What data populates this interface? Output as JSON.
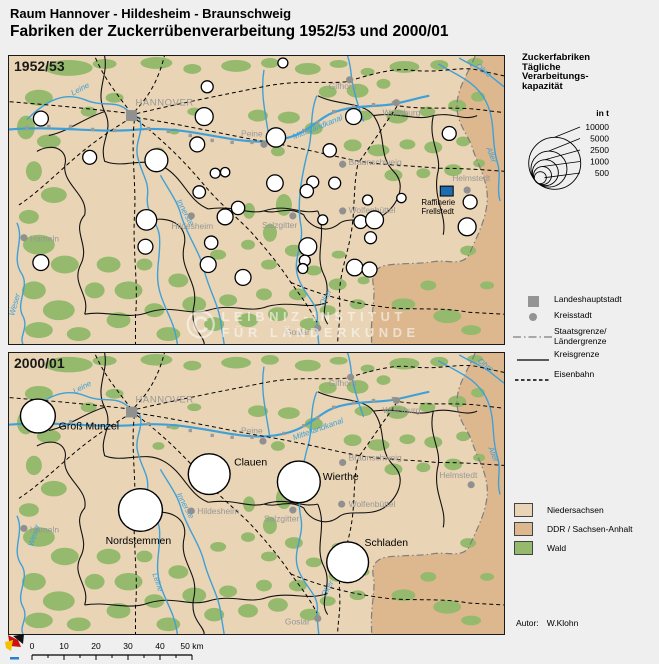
{
  "header": {
    "region_line": "Raum Hannover - Hildesheim - Braunschweig",
    "title_line": "Fabriken der Zuckerrübenverarbeitung 1952/53 und 2000/01"
  },
  "watermark": {
    "symbol": "©",
    "line1": "LEIBNIZ-INSTITUT",
    "line2": "FÜR LÄNDERKUNDE"
  },
  "colors": {
    "niedersachsen": "#e9d4b5",
    "ddr": "#ddb88f",
    "wald": "#95b96d",
    "river": "#3fa0d8",
    "city_gray": "#979797",
    "factory_fill": "#ffffff",
    "factory_stroke": "#000000",
    "refinery_blue": "#1b6db0"
  },
  "map_1952": {
    "year_label": "1952/53",
    "cities": [
      {
        "name": "HANNOVER",
        "type": "capital",
        "dot": [
          123,
          60
        ],
        "label": [
          127,
          50
        ],
        "anchor": "start",
        "caps": true
      },
      {
        "name": "Gifhorn",
        "type": "kreis",
        "dot": [
          342,
          24
        ],
        "label": [
          321,
          33
        ],
        "anchor": "start"
      },
      {
        "name": "Wolfsburg",
        "type": "kreis",
        "dot": [
          389,
          47
        ],
        "label": [
          375,
          60
        ],
        "anchor": "start"
      },
      {
        "name": "Braunschweig",
        "type": "kreis",
        "dot": [
          335,
          109
        ],
        "label": [
          341,
          110
        ],
        "anchor": "start"
      },
      {
        "name": "Peine",
        "type": "kreis",
        "dot": [
          256,
          89
        ],
        "label": [
          233,
          81
        ],
        "anchor": "start"
      },
      {
        "name": "Salzgitter",
        "type": "kreis",
        "dot": [
          285,
          161
        ],
        "label": [
          254,
          173
        ],
        "anchor": "start"
      },
      {
        "name": "Hildesheim",
        "type": "kreis",
        "dot": [
          183,
          161
        ],
        "label": [
          163,
          174
        ],
        "anchor": "start"
      },
      {
        "name": "Hameln",
        "type": "kreis",
        "dot": [
          15,
          183
        ],
        "label": [
          21,
          187
        ],
        "anchor": "start"
      },
      {
        "name": "Wolfenbüttel",
        "type": "kreis",
        "dot": [
          335,
          156
        ],
        "label": [
          341,
          158
        ],
        "anchor": "start"
      },
      {
        "name": "Helmstedt",
        "type": "kreis",
        "dot": [
          460,
          135
        ],
        "label": [
          445,
          126
        ],
        "anchor": "start"
      },
      {
        "name": "Goslar",
        "type": "kreis",
        "dot": [
          310,
          274
        ],
        "label": [
          277,
          281
        ],
        "anchor": "start"
      }
    ],
    "river_labels": [
      {
        "name": "Leine",
        "x": 64,
        "y": 40,
        "rot": -28
      },
      {
        "name": "Mittellandkanal",
        "x": 286,
        "y": 84,
        "rot": -22
      },
      {
        "name": "Innerste",
        "x": 168,
        "y": 146,
        "rot": 62
      },
      {
        "name": "Ohre",
        "x": 468,
        "y": 11,
        "rot": 38
      },
      {
        "name": "Aller",
        "x": 479,
        "y": 93,
        "rot": 68
      },
      {
        "name": "Oker",
        "x": 316,
        "y": 252,
        "rot": -62
      },
      {
        "name": "Weser",
        "x": 5,
        "y": 262,
        "rot": -74
      }
    ],
    "factories": [
      [
        199,
        31,
        6
      ],
      [
        275,
        7,
        5
      ],
      [
        196,
        61,
        9
      ],
      [
        32,
        63,
        7.5
      ],
      [
        81,
        102,
        7
      ],
      [
        148,
        105,
        11.5
      ],
      [
        189,
        89,
        7.5
      ],
      [
        207,
        118,
        5
      ],
      [
        217,
        117,
        4.7
      ],
      [
        191,
        137,
        6.3
      ],
      [
        346,
        61,
        8
      ],
      [
        268,
        82,
        9.7
      ],
      [
        322,
        95,
        6.7
      ],
      [
        442,
        78,
        7
      ],
      [
        267,
        128,
        8.3
      ],
      [
        305,
        127,
        6
      ],
      [
        299,
        136,
        6.7
      ],
      [
        327,
        128,
        6
      ],
      [
        360,
        145,
        5
      ],
      [
        394,
        143,
        4.7
      ],
      [
        463,
        147,
        7
      ],
      [
        138,
        165,
        10.3
      ],
      [
        137,
        192,
        7.5
      ],
      [
        32,
        208,
        8
      ],
      [
        217,
        162,
        8
      ],
      [
        230,
        153,
        6.7
      ],
      [
        203,
        188,
        6.7
      ],
      [
        200,
        210,
        8
      ],
      [
        235,
        223,
        8
      ],
      [
        315,
        165,
        5
      ],
      [
        353,
        167,
        6.7
      ],
      [
        367,
        165,
        9
      ],
      [
        363,
        183,
        6
      ],
      [
        300,
        192,
        9
      ],
      [
        297,
        206,
        5.5
      ],
      [
        295,
        214,
        5
      ],
      [
        347,
        213,
        8.3
      ],
      [
        362,
        215,
        7.5
      ],
      [
        460,
        172,
        9
      ]
    ],
    "refinery": {
      "label_line1": "Raffinerie",
      "label_line2": "Frellstedt",
      "x": 433,
      "y": 131,
      "w": 13,
      "h": 10,
      "tx": 414,
      "ty1": 150,
      "ty2": 159
    }
  },
  "map_2000": {
    "year_label": "2000/01",
    "cities": [
      {
        "name": "HANNOVER",
        "type": "capital",
        "dot": [
          123,
          61
        ],
        "label": [
          127,
          51
        ],
        "anchor": "start",
        "caps": true
      },
      {
        "name": "Gifhorn",
        "type": "kreis",
        "dot": [
          343,
          25
        ],
        "label": [
          321,
          34
        ],
        "anchor": "start"
      },
      {
        "name": "Wolfsburg",
        "type": "kreis",
        "dot": [
          389,
          49
        ],
        "label": [
          375,
          62
        ],
        "anchor": "start"
      },
      {
        "name": "Braunschweig",
        "type": "kreis",
        "dot": [
          335,
          113
        ],
        "label": [
          341,
          111
        ],
        "anchor": "start"
      },
      {
        "name": "Peine",
        "type": "kreis",
        "dot": [
          255,
          91
        ],
        "label": [
          233,
          83
        ],
        "anchor": "start"
      },
      {
        "name": "Salzgitter",
        "type": "kreis",
        "dot": [
          285,
          162
        ],
        "label": [
          256,
          174
        ],
        "anchor": "start"
      },
      {
        "name": "Hildesheim",
        "type": "kreis",
        "dot": [
          183,
          163
        ],
        "label": [
          189,
          166
        ],
        "anchor": "start"
      },
      {
        "name": "Hameln",
        "type": "kreis",
        "dot": [
          15,
          181
        ],
        "label": [
          21,
          185
        ],
        "anchor": "start"
      },
      {
        "name": "Wolfenbüttel",
        "type": "kreis",
        "dot": [
          334,
          156
        ],
        "label": [
          341,
          159
        ],
        "anchor": "start"
      },
      {
        "name": "Helmstedt",
        "type": "kreis",
        "dot": [
          464,
          136
        ],
        "label": [
          432,
          129
        ],
        "anchor": "start"
      },
      {
        "name": "Goslar",
        "type": "kreis",
        "dot": [
          310,
          274
        ],
        "label": [
          277,
          280
        ],
        "anchor": "start"
      }
    ],
    "river_labels": [
      {
        "name": "Leine",
        "x": 66,
        "y": 42,
        "rot": -28
      },
      {
        "name": "Mittellandkanal",
        "x": 286,
        "y": 90,
        "rot": -20
      },
      {
        "name": "Innerste",
        "x": 168,
        "y": 146,
        "rot": 62
      },
      {
        "name": "Leine",
        "x": 144,
        "y": 228,
        "rot": 72
      },
      {
        "name": "Ohre",
        "x": 470,
        "y": 9,
        "rot": 38
      },
      {
        "name": "Aller",
        "x": 481,
        "y": 98,
        "rot": 68
      },
      {
        "name": "Oker",
        "x": 318,
        "y": 252,
        "rot": -62
      },
      {
        "name": "Weser",
        "x": 24,
        "y": 200,
        "rot": -72
      }
    ],
    "factories": [
      {
        "name": "Groß Munzel",
        "x": 29,
        "y": 65,
        "r": 17.5,
        "lx": 50,
        "ly": 79
      },
      {
        "name": "Clauen",
        "x": 201,
        "y": 125,
        "r": 21,
        "lx": 226,
        "ly": 116
      },
      {
        "name": "Wierthe",
        "x": 291,
        "y": 133,
        "r": 21.5,
        "lx": 315,
        "ly": 131
      },
      {
        "name": "Nordstemmen",
        "x": 132,
        "y": 162,
        "r": 22,
        "lx": 97,
        "ly": 197
      },
      {
        "name": "Schladen",
        "x": 340,
        "y": 216,
        "r": 21,
        "lx": 357,
        "ly": 199
      }
    ]
  },
  "legend_sizes": {
    "heading_lines": [
      "Zuckerfabriken",
      "Tägliche",
      "Verarbeitungs-",
      "kapazität"
    ],
    "unit_label": "in t",
    "items": [
      {
        "value": "10000",
        "r": 26
      },
      {
        "value": "5000",
        "r": 18
      },
      {
        "value": "2500",
        "r": 13
      },
      {
        "value": "1000",
        "r": 9
      },
      {
        "value": "500",
        "r": 6
      }
    ]
  },
  "legend_symbols": {
    "items": [
      {
        "key": "landeshauptstadt",
        "label": "Landeshauptstadt"
      },
      {
        "key": "kreisstadt",
        "label": "Kreisstadt"
      },
      {
        "key": "staatsgrenze",
        "label": "Staatsgrenze/",
        "label2": "Ländergrenze"
      },
      {
        "key": "kreisgrenze",
        "label": "Kreisgrenze"
      },
      {
        "key": "eisenbahn",
        "label": "Eisenbahn"
      }
    ]
  },
  "legend_areas": {
    "items": [
      {
        "color_key": "niedersachsen",
        "label": "Niedersachsen"
      },
      {
        "color_key": "ddr",
        "label": "DDR / Sachsen-Anhalt"
      },
      {
        "color_key": "wald",
        "label": "Wald"
      }
    ]
  },
  "scalebar": {
    "ticks": [
      "0",
      "10",
      "20",
      "30",
      "40"
    ],
    "end_label": "50 km",
    "km_per_tick": 10
  },
  "author": {
    "prefix": "Autor:",
    "name": "W.Klohn"
  }
}
